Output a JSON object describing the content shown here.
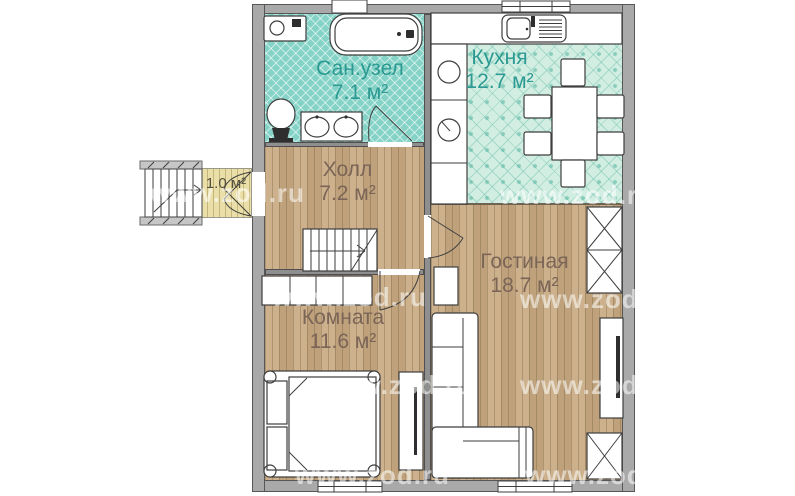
{
  "watermark": "www.zod.ru",
  "rooms": {
    "bathroom": {
      "name": "Сан.узел",
      "area": "7.1 м²"
    },
    "kitchen": {
      "name": "Кухня",
      "area": "12.7 м²"
    },
    "hall": {
      "name": "Холл",
      "area": "7.2 м²"
    },
    "bedroom": {
      "name": "Комната",
      "area": "11.6 м²"
    },
    "living": {
      "name": "Гостиная",
      "area": "18.7 м²"
    },
    "porch": {
      "area": "1.0 м²"
    }
  },
  "furniture": [
    "bathtub",
    "washing-machine",
    "toilet",
    "double-sink-vanity",
    "kitchen-sink",
    "cooktop",
    "dining-table",
    "chair",
    "staircase",
    "entrance-stairs",
    "wardrobe",
    "closet",
    "bed",
    "desk",
    "side-table",
    "corner-sofa",
    "tv-stand",
    "window",
    "door"
  ],
  "colors": {
    "wall": "#a9a9a9",
    "wood_floor": "#c9ab83",
    "bathroom_tile": "#84d3c6",
    "kitchen_tile": "#d2eee2",
    "porch_floor": "#eadfa9",
    "label_teal": "#2c9a92",
    "label_brown": "#7b6557"
  }
}
